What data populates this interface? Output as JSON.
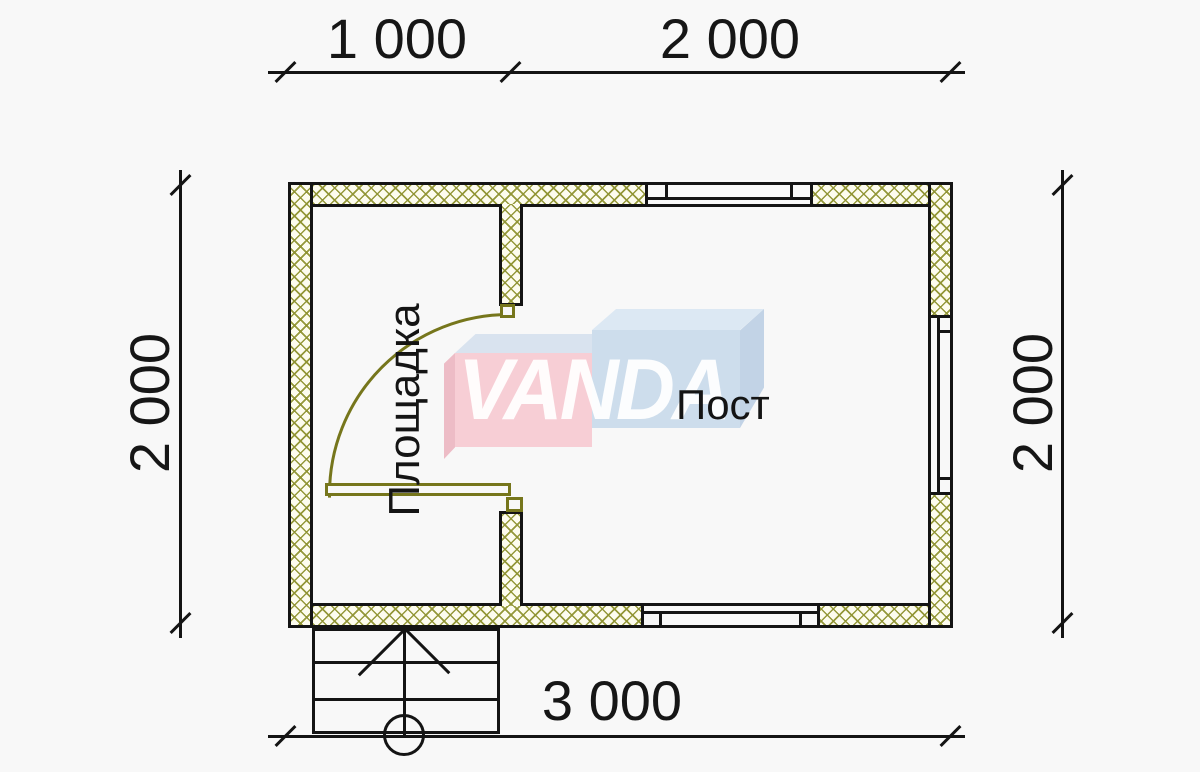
{
  "plan": {
    "type": "floor-plan",
    "rooms": [
      {
        "name": "Площадка"
      },
      {
        "name": "Пост"
      }
    ],
    "dimensions": {
      "top": [
        "1 000",
        "2 000"
      ],
      "left": "2 000",
      "right": "2 000",
      "bottom": "3 000"
    },
    "watermark": {
      "text": "VANDA"
    },
    "colors": {
      "background": "#f8f8f8",
      "line": "#141414",
      "wall_hatch": "#8f9331",
      "wall_fill": "#fdfcee",
      "door": "#76761c",
      "watermark_pink": "#f7ced5",
      "watermark_pink_side": "#edbcc6",
      "watermark_blue": "#cdddec",
      "watermark_blue_top": "#dce8f3",
      "watermark_blue_side": "#c2d3e6",
      "watermark_text": "#ffffff"
    }
  }
}
